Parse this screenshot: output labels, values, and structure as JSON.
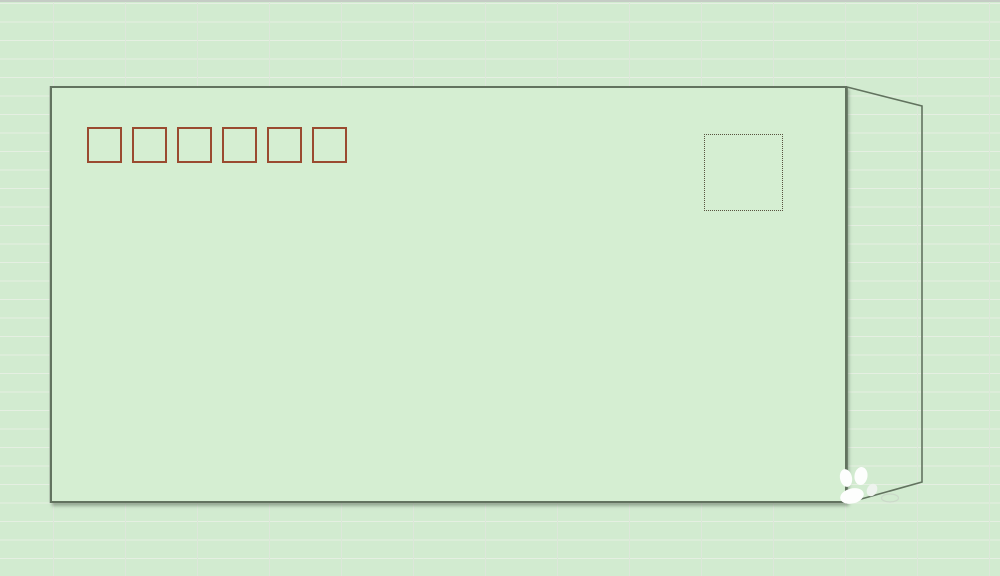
{
  "window": {
    "top_band_color": "#c5ccc5"
  },
  "spreadsheet": {
    "cell_color": "#d2ebd0",
    "h_gridline_color": "#e5efe2",
    "v_gridline_color": "#dde7da",
    "row_height_px": 18.5,
    "column_width_px": 72
  },
  "envelope": {
    "fill_color": "#d5eed2",
    "outline_color": "#62735f",
    "postal_code_boxes": {
      "count": 6,
      "outline_color": "#9a4a30"
    },
    "stamp_box": {
      "outline_color": "#58523f",
      "border_style": "dotted"
    },
    "flap": {
      "outline_color": "#62735f"
    }
  },
  "watermark": {
    "icon": "paw-print-icon",
    "primary_color": "#fdfefd",
    "secondary_color": "#eef3ee",
    "outline_color": "#c9d4c7"
  }
}
